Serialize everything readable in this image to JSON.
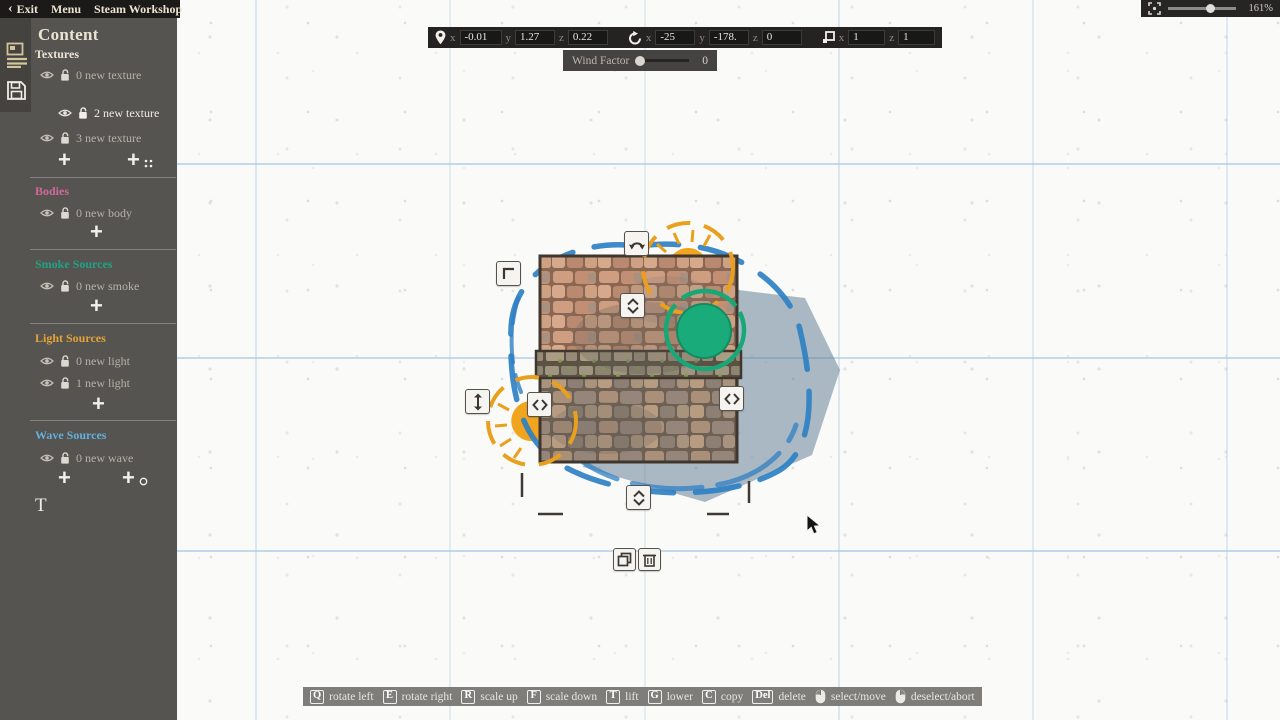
{
  "menubar": {
    "back": "‹",
    "exit": "Exit",
    "menu": "Menu",
    "workshop": "Steam Workshop"
  },
  "zoom_control": {
    "value": "161%"
  },
  "transform_bar": {
    "axis": {
      "x": "x",
      "y": "y",
      "z": "z"
    },
    "position": {
      "x": "-0.01",
      "y": "1.27",
      "z": "0.22"
    },
    "rotation": {
      "x": "-25",
      "y": "-178.",
      "z": "0"
    },
    "scale": {
      "x": "1",
      "z": "1"
    }
  },
  "wind": {
    "label": "Wind Factor",
    "value": "0"
  },
  "sidebar": {
    "title": "Content",
    "add_label": "+",
    "text_tool": "T",
    "sections": [
      {
        "label": "Textures",
        "color": "#ece5d3",
        "items": [
          {
            "label": "0 new texture"
          },
          {
            "label": "2 new texture",
            "selected": true
          },
          {
            "label": "3 new texture"
          }
        ]
      },
      {
        "label": "Bodies",
        "color": "#d2689a",
        "items": [
          {
            "label": "0 new body"
          }
        ]
      },
      {
        "label": "Smoke Sources",
        "color": "#1fa384",
        "items": [
          {
            "label": "0 new smoke"
          }
        ]
      },
      {
        "label": "Light Sources",
        "color": "#e2a338",
        "items": [
          {
            "label": "0 new light"
          },
          {
            "label": "1 new light"
          }
        ]
      },
      {
        "label": "Wave Sources",
        "color": "#63b0dc",
        "items": [
          {
            "label": "0 new wave"
          }
        ]
      }
    ]
  },
  "hotkeys": {
    "items": [
      {
        "key": "Q",
        "label": "rotate left"
      },
      {
        "key": "E",
        "label": "rotate right"
      },
      {
        "key": "R",
        "label": "scale up"
      },
      {
        "key": "F",
        "label": "scale down"
      },
      {
        "key": "T",
        "label": "lift"
      },
      {
        "key": "G",
        "label": "lower"
      },
      {
        "key": "C",
        "label": "copy"
      },
      {
        "key": "Del",
        "label": "delete"
      },
      {
        "mouse": "left",
        "label": "select/move"
      },
      {
        "mouse": "right",
        "label": "deselect/abort"
      }
    ]
  },
  "colors": {
    "accent_green": "#19ab79",
    "accent_orange": "#eca01f",
    "accent_blue": "#2f80c3",
    "shadow_blue": "#607a94"
  }
}
